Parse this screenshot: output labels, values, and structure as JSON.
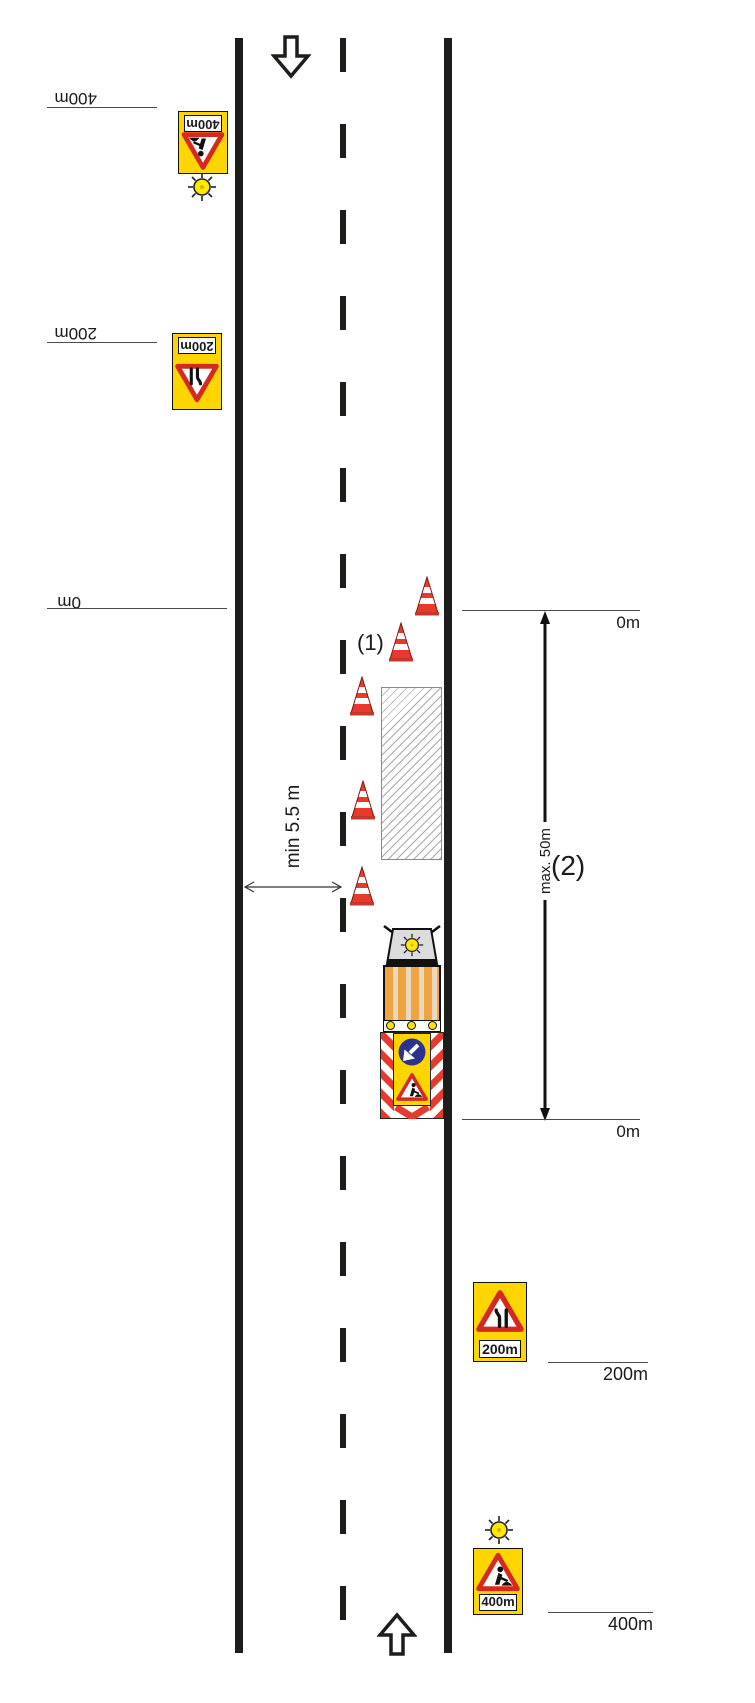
{
  "annotations": {
    "cone_note": "(1)",
    "zone_note": "(2)",
    "lane_width": "min 5.5 m",
    "zone_length": "max. 50m"
  },
  "left_markers": [
    {
      "label": "400m"
    },
    {
      "label": "200m"
    },
    {
      "label": "0m"
    }
  ],
  "right_markers": [
    {
      "label": "0m"
    },
    {
      "label": "0m"
    },
    {
      "label": "200m"
    },
    {
      "label": "400m"
    }
  ],
  "signs": {
    "left_roadworks": {
      "distance": "400m",
      "symbol": "roadworks-icon",
      "beacon": true
    },
    "left_narrows": {
      "distance": "200m",
      "symbol": "road-narrows-icon",
      "beacon": false
    },
    "right_narrows": {
      "distance": "200m",
      "symbol": "road-narrows-icon",
      "beacon": false
    },
    "right_roadworks": {
      "distance": "400m",
      "symbol": "roadworks-icon",
      "beacon": true
    }
  },
  "colors": {
    "road_line": "#1d1d1b",
    "sign_yellow": "#ffd500",
    "sign_red": "#d5281e",
    "cone_red": "#e8392d",
    "mandatory_blue": "#2d3190",
    "truck_orange": "#f0a341",
    "beacon_yellow": "#ffe800"
  }
}
